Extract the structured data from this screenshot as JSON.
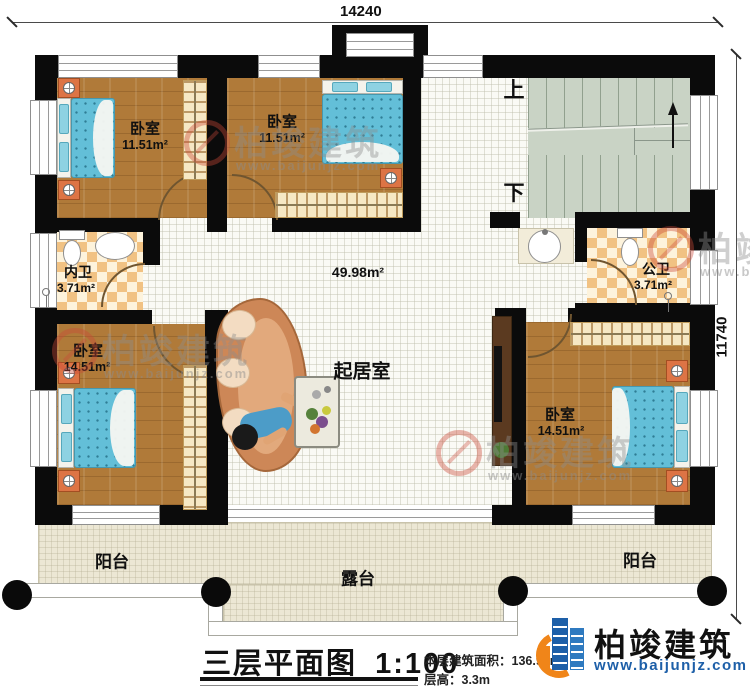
{
  "dimensions": {
    "width_label": "14240",
    "height_label": "11740"
  },
  "stairs": {
    "up_label": "上",
    "down_label": "下"
  },
  "rooms": {
    "bedroom_tl": {
      "label": "卧室",
      "area": "11.51m²"
    },
    "bedroom_tm": {
      "label": "卧室",
      "area": "11.51m²"
    },
    "bath_left": {
      "label": "内卫",
      "area": "3.71m²"
    },
    "bath_right": {
      "label": "公卫",
      "area": "3.71m²"
    },
    "bedroom_bl": {
      "label": "卧室",
      "area": "14.51m²"
    },
    "bedroom_br": {
      "label": "卧室",
      "area": "14.51m²"
    },
    "living": {
      "label": "起居室",
      "area": "49.98m²"
    },
    "balcony_left": {
      "label": "阳台"
    },
    "balcony_right": {
      "label": "阳台"
    },
    "terrace": {
      "label": "露台"
    }
  },
  "titleblock": {
    "title": "三层平面图",
    "scale": "1:100",
    "floor_area": "本层建筑面积：136.92m²",
    "floor_height": "层高：3.3m"
  },
  "brand": {
    "name": "柏竣建筑",
    "website": "www.baijunjz.com"
  },
  "watermark": {
    "name": "柏竣建筑",
    "website": "www.baijunjz.com"
  },
  "colors": {
    "wall": "#0b0b0b",
    "wood_floor": "#b07a39",
    "bed_blue": "#63bfd8",
    "bath_tile": "#f1c283",
    "stairs": "#c9d3c5",
    "balcony": "#ece7d4",
    "brand_blue": "#1d5fa8",
    "brand_orange": "#f08519"
  }
}
